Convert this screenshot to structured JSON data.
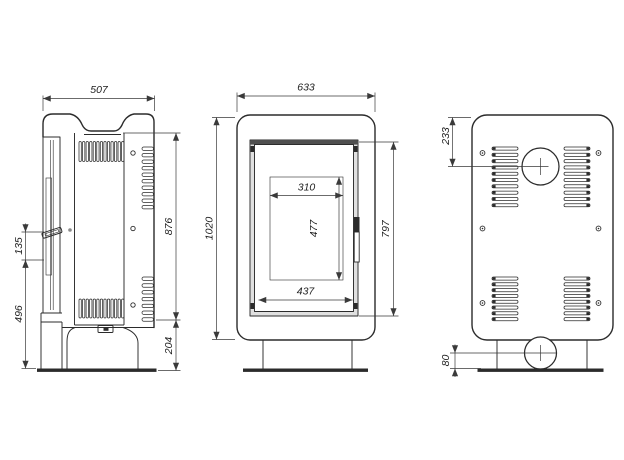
{
  "title": "stove-three-view-technical-drawing",
  "colors": {
    "line": "#2b2b2b",
    "dim": "#3a3a3a",
    "dark": "#4f4f4f",
    "light": "#e0e0e0",
    "background": "#ffffff"
  },
  "dims": {
    "side_width": "507",
    "side_body_height": "876",
    "side_base_height": "204",
    "side_handle_offset": "135",
    "side_handle_height": "496",
    "front_width": "633",
    "front_height": "1020",
    "glass_width": "310",
    "glass_height": "477",
    "door_width": "437",
    "door_height": "797",
    "back_flue_offset": "233",
    "back_intake_height": "80"
  },
  "vents": {
    "side_top": 13,
    "side_bottom": 13,
    "side_rear_top": 10,
    "side_rear_bottom": 7,
    "back_top": 10,
    "back_bottom": 8
  }
}
